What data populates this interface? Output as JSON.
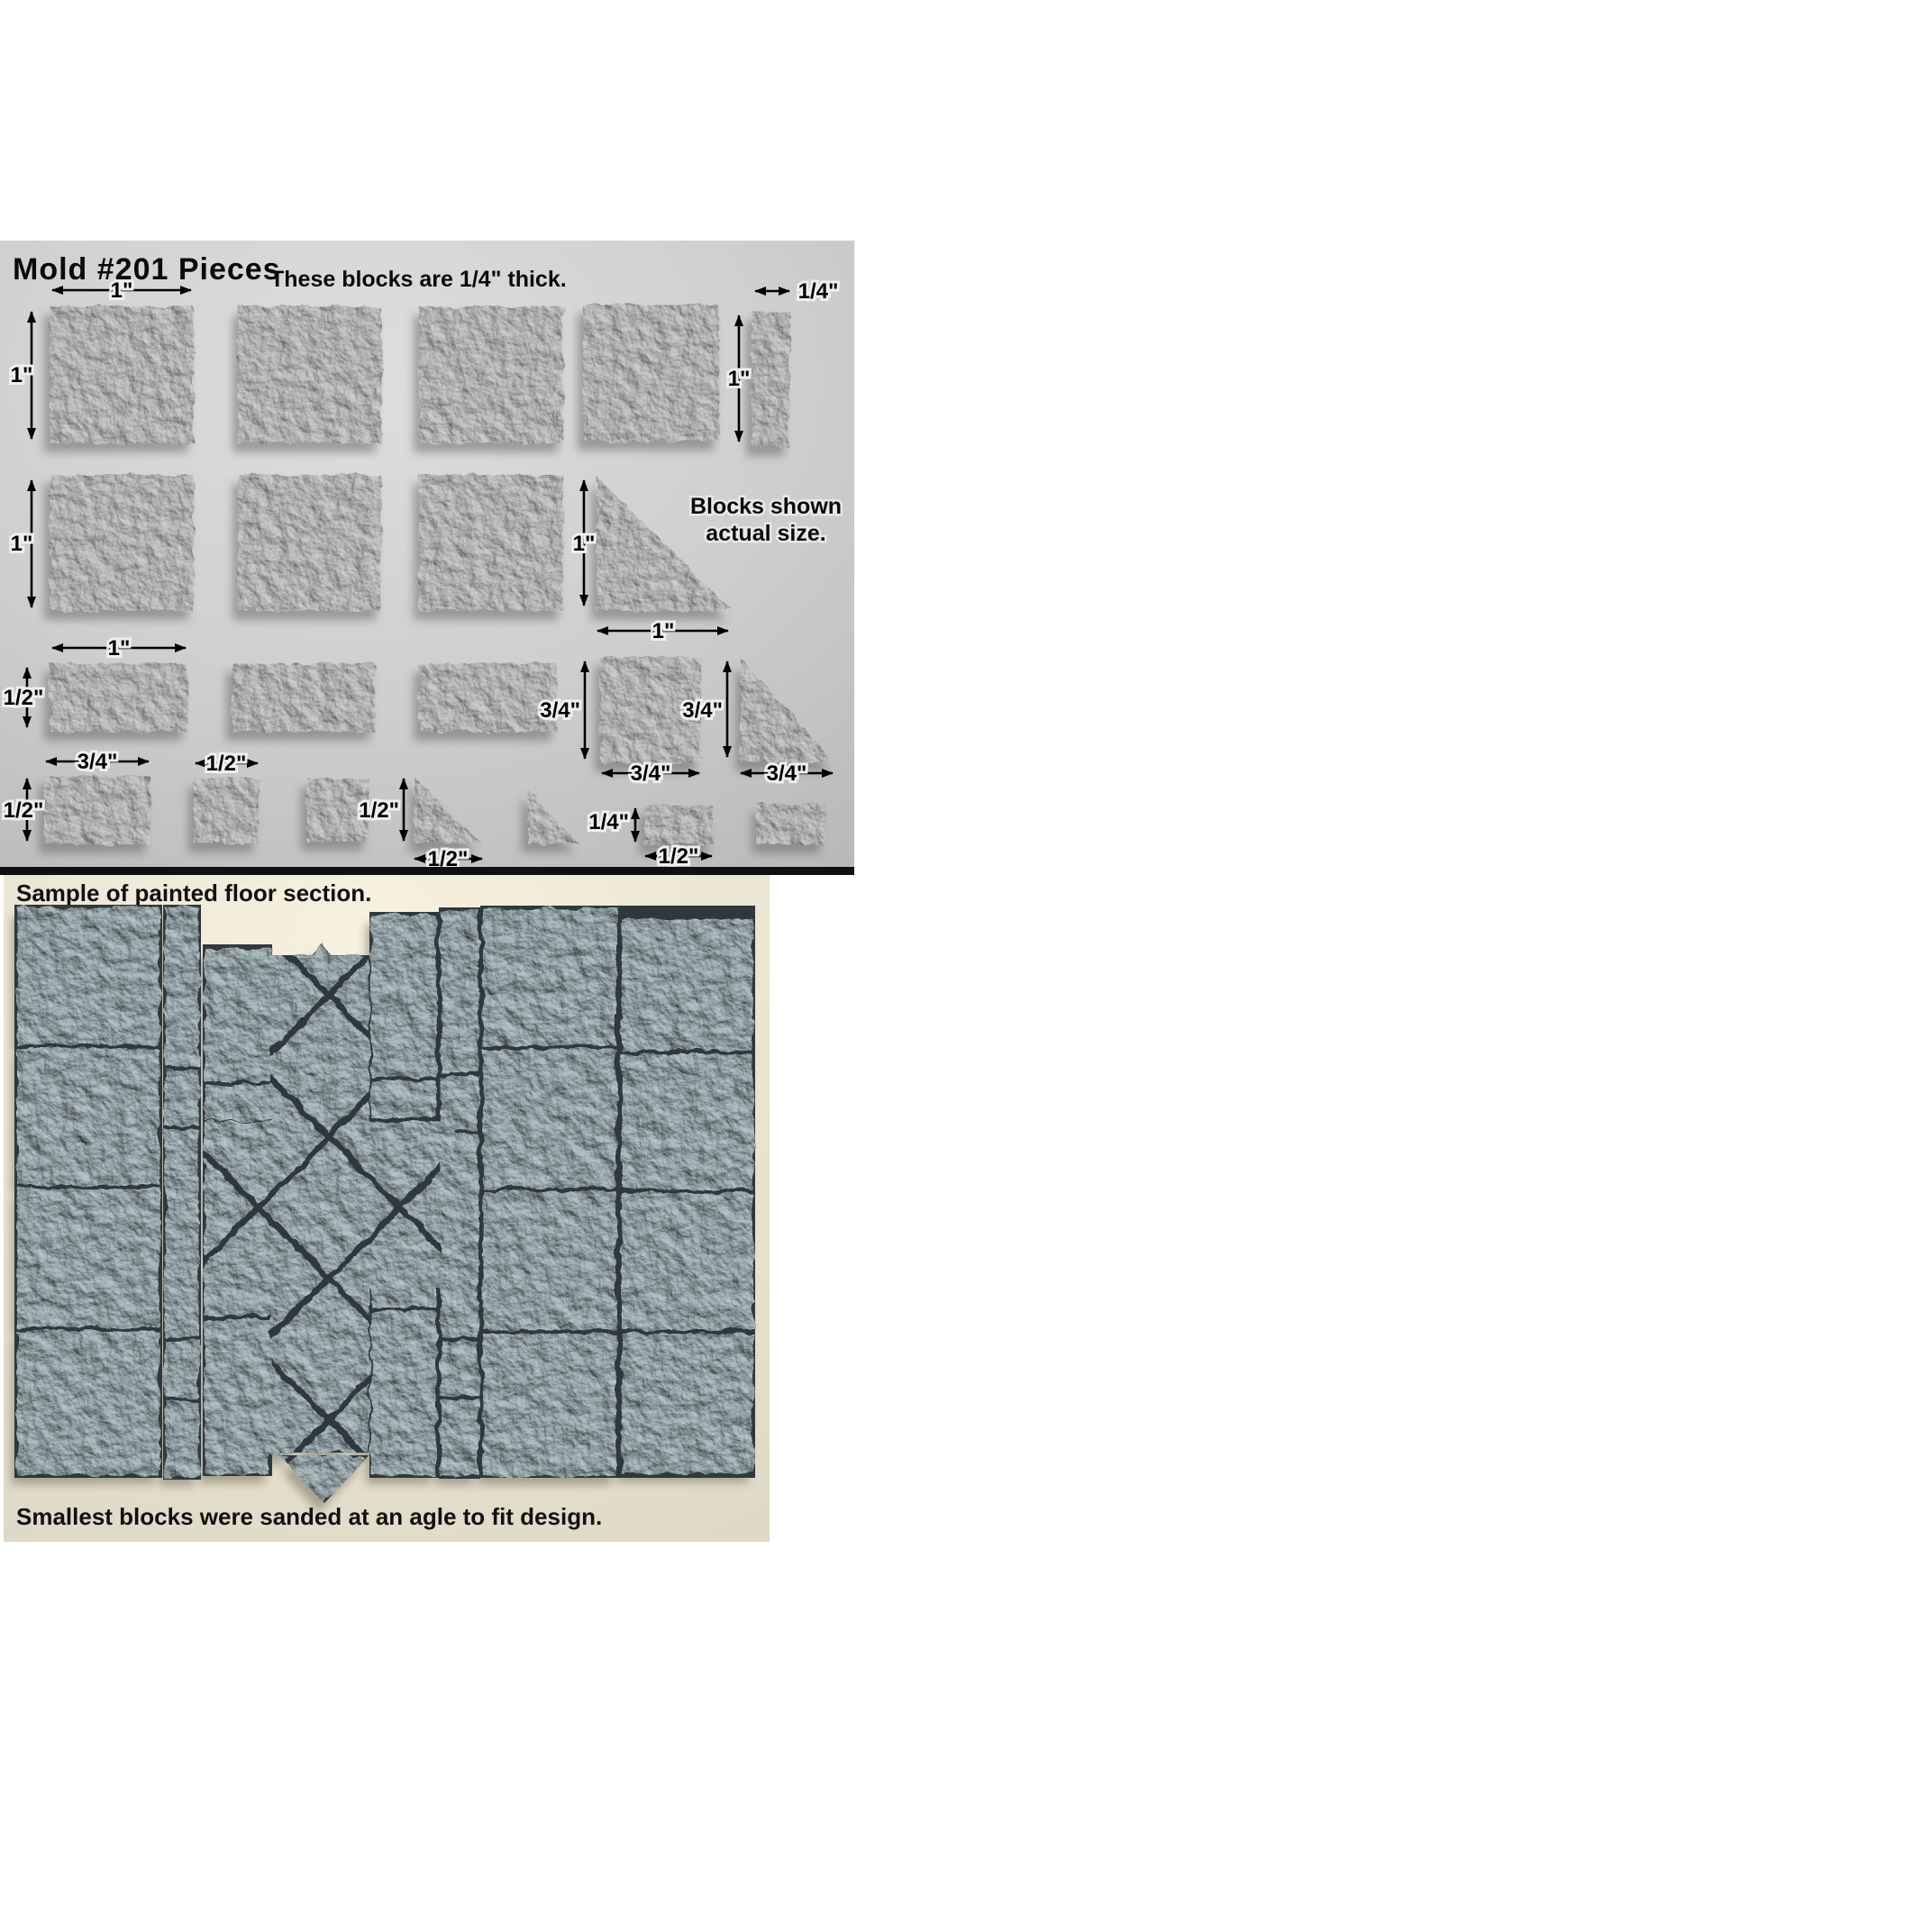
{
  "top_panel": {
    "title": "Mold #201  Pieces",
    "subtitle": "These blocks are 1/4\" thick.",
    "note_line1": "Blocks shown",
    "note_line2": "actual size.",
    "dim_labels": [
      "1\"",
      "1\"",
      "1/4\"",
      "1\"",
      "1\"",
      "1\"",
      "1\"",
      "1\"",
      "1/2\"",
      "3/4\"",
      "3/4\"",
      "3/4\"",
      "3/4\"",
      "3/4\"",
      "1/2\"",
      "1/2\"",
      "1/2\"",
      "1/2\"",
      "1/4\"",
      "1/2\""
    ]
  },
  "bottom_panel": {
    "caption_top": "Sample of painted floor section.",
    "caption_bottom": "Smallest blocks were sanded at an agle to fit design."
  },
  "colors": {
    "page_bg": "#ffffff",
    "top_photo_bg": "#cfcfcf",
    "block_gray": "#d0d0d0",
    "divider_black": "#101010",
    "floor_bg": "#ece6d4",
    "stone_blue": "#b7c9cd",
    "grout_dark": "#2f383d",
    "shadow_gray": "#5f5f5f",
    "shadow_warm": "#6b6557",
    "label_text": "#000000"
  }
}
